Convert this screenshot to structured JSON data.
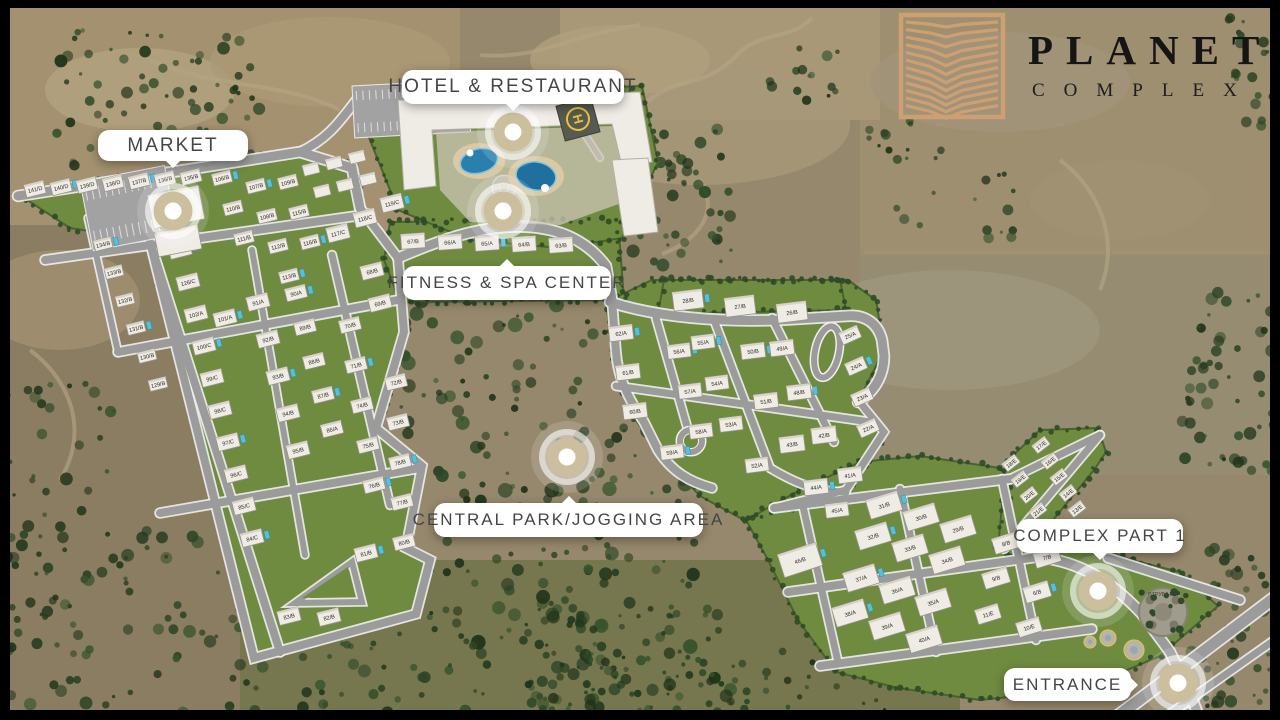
{
  "brand": {
    "title": "PLANET",
    "subtitle": "COMPLEX",
    "logo_color": "#cf9f74",
    "title_color": "#151515"
  },
  "callouts": [
    {
      "id": "market",
      "label": "MARKET",
      "x": 98,
      "y": 130,
      "w": 150,
      "h": 31,
      "font": 19,
      "pointer": "bottom",
      "marker_x": 173,
      "marker_y": 211
    },
    {
      "id": "hotel-restaurant",
      "label": "HOTEL & RESTAURANT",
      "x": 402,
      "y": 70,
      "w": 222,
      "h": 34,
      "font": 19,
      "pointer": "bottom",
      "marker_x": 513,
      "marker_y": 132
    },
    {
      "id": "fitness-spa",
      "label": "FITNESS & SPA CENTER",
      "x": 403,
      "y": 266,
      "w": 208,
      "h": 34,
      "font": 17,
      "pointer": "top",
      "marker_x": 503,
      "marker_y": 211
    },
    {
      "id": "central-park",
      "label": "CENTRAL PARK/JOGGING AREA",
      "x": 434,
      "y": 503,
      "w": 269,
      "h": 34,
      "font": 17,
      "pointer": "top",
      "marker_x": 567,
      "marker_y": 457
    },
    {
      "id": "complex-part-1",
      "label": "COMPLEX PART 1",
      "x": 1017,
      "y": 519,
      "w": 166,
      "h": 34,
      "font": 17,
      "pointer": "bottom",
      "marker_x": 1098,
      "marker_y": 591
    },
    {
      "id": "entrance",
      "label": "ENTRANCE",
      "x": 1004,
      "y": 668,
      "w": 127,
      "h": 33,
      "font": 17,
      "pointer": "right",
      "marker_x": 1178,
      "marker_y": 683
    }
  ],
  "map": {
    "colors": {
      "marker": "#cbbf9d",
      "lawn": "#6e8b40",
      "lawn_edge": "#49632f",
      "road": "#9b9b9b",
      "road_edge": "#efefef",
      "forest": "#2c4426",
      "terrain": "#96886c",
      "house": "#efece5",
      "pool": "#2a7fae"
    },
    "helipad": {
      "label": "H"
    },
    "stone_circle_label": "ВТРУБІНКА"
  },
  "houses": {
    "left_rows": [
      {
        "x": 35,
        "y": 189,
        "dx": 26,
        "dy": -2,
        "n": 7,
        "rot": -14,
        "w": 20,
        "h": 13,
        "labels": [
          "141/D",
          "140/D",
          "139/D",
          "138/D",
          "137/B",
          "136/B",
          "135/B"
        ]
      },
      {
        "x": 103,
        "y": 244,
        "dx": 11,
        "dy": 28,
        "n": 6,
        "rot": -14,
        "w": 18,
        "h": 11,
        "labels": [
          "134/B",
          "133/B",
          "132/B",
          "131/B",
          "130/B",
          "129/B"
        ]
      },
      {
        "x": 180,
        "y": 250,
        "dx": 8,
        "dy": 32,
        "n": 10,
        "rot": -14,
        "w": 22,
        "h": 14,
        "labels": [
          "127/C",
          "126/C",
          "102/A",
          "100/C",
          "99/C",
          "98/C",
          "97/C",
          "96/C",
          "85/C",
          "84/C"
        ]
      },
      {
        "x": 258,
        "y": 302,
        "dx": 10,
        "dy": 37,
        "n": 5,
        "rot": -14,
        "w": 22,
        "h": 14,
        "labels": [
          "91/A",
          "92/B",
          "93/B",
          "94/B",
          "95/B"
        ]
      },
      {
        "x": 296,
        "y": 293,
        "dx": 9,
        "dy": 34,
        "n": 5,
        "rot": -14,
        "w": 21,
        "h": 13,
        "labels": [
          "90/A",
          "89/B",
          "88/B",
          "87/B",
          "86/A"
        ]
      },
      {
        "x": 350,
        "y": 325,
        "dx": 6,
        "dy": 40,
        "n": 5,
        "rot": -14,
        "w": 21,
        "h": 13,
        "labels": [
          "70/B",
          "71/B",
          "74/B",
          "75/B",
          "76/B"
        ]
      },
      {
        "x": 396,
        "y": 382,
        "dx": 2,
        "dy": 40,
        "n": 5,
        "rot": -14,
        "w": 21,
        "h": 13,
        "labels": [
          "72/B",
          "73/B",
          "78/B",
          "77/B",
          "80/B"
        ]
      },
      {
        "x": 222,
        "y": 178,
        "dx": 11,
        "dy": 30,
        "n": 3,
        "rot": -14,
        "w": 19,
        "h": 12,
        "labels": [
          "106/B",
          "110/B",
          "111/B"
        ]
      },
      {
        "x": 256,
        "y": 186,
        "dx": 11,
        "dy": 30,
        "n": 4,
        "rot": -14,
        "w": 19,
        "h": 12,
        "labels": [
          "107/B",
          "108/B",
          "112/B",
          "113/B"
        ]
      },
      {
        "x": 288,
        "y": 182,
        "dx": 11,
        "dy": 30,
        "n": 3,
        "rot": -14,
        "w": 19,
        "h": 12,
        "labels": [
          "109/B",
          "115/B",
          "116/B"
        ]
      },
      {
        "x": 338,
        "y": 233,
        "dx": 27,
        "dy": -15,
        "n": 3,
        "rot": -14,
        "w": 22,
        "h": 15,
        "labels": [
          "117/C",
          "118/C",
          "119/C"
        ]
      },
      {
        "x": 311,
        "y": 169,
        "dx": 23,
        "dy": -6,
        "n": 3,
        "rot": -14,
        "w": 16,
        "h": 11,
        "labels": [
          "",
          "",
          ""
        ]
      },
      {
        "x": 322,
        "y": 191,
        "dx": 23,
        "dy": -6,
        "n": 3,
        "rot": -14,
        "w": 16,
        "h": 11,
        "labels": [
          "",
          "",
          ""
        ]
      },
      {
        "x": 413,
        "y": 241,
        "dx": 37,
        "dy": 1,
        "n": 5,
        "rot": -4,
        "w": 24,
        "h": 15,
        "labels": [
          "67/B",
          "66/A",
          "65/A",
          "64/B",
          "63/B"
        ]
      }
    ],
    "left_singles": [
      {
        "x": 366,
        "y": 553,
        "label": "81/B"
      },
      {
        "x": 289,
        "y": 616,
        "label": "83/B"
      },
      {
        "x": 329,
        "y": 617,
        "label": "82/B"
      },
      {
        "x": 225,
        "y": 318,
        "label": "101/A"
      },
      {
        "x": 372,
        "y": 271,
        "label": "68/B"
      },
      {
        "x": 380,
        "y": 303,
        "label": "69/B"
      }
    ],
    "right_rows": [
      {
        "x": 688,
        "y": 300,
        "dx": 52,
        "dy": 6,
        "n": 3,
        "rot": -7,
        "w": 30,
        "h": 19,
        "labels": [
          "28/B",
          "27/B",
          "26/B"
        ]
      },
      {
        "x": 621,
        "y": 333,
        "dx": 7,
        "dy": 39,
        "n": 3,
        "rot": -7,
        "w": 24,
        "h": 15,
        "labels": [
          "62/A",
          "61/B",
          "60/B"
        ]
      },
      {
        "x": 679,
        "y": 351,
        "dx": 11,
        "dy": 40,
        "n": 3,
        "rot": -7,
        "w": 23,
        "h": 14,
        "labels": [
          "56/A",
          "57/A",
          "58/A"
        ]
      },
      {
        "x": 703,
        "y": 342,
        "dx": 14,
        "dy": 41,
        "n": 3,
        "rot": -7,
        "w": 23,
        "h": 14,
        "labels": [
          "55/A",
          "54/A",
          "53/A"
        ]
      },
      {
        "x": 753,
        "y": 351,
        "dx": 13,
        "dy": 50,
        "n": 2,
        "rot": -7,
        "w": 24,
        "h": 15,
        "labels": [
          "50/B",
          "51/B"
        ]
      },
      {
        "x": 782,
        "y": 348,
        "dx": 17,
        "dy": 44,
        "n": 2,
        "rot": -7,
        "w": 24,
        "h": 15,
        "labels": [
          "49/A",
          "48/B"
        ]
      },
      {
        "x": 792,
        "y": 444,
        "dx": 32,
        "dy": -9,
        "n": 2,
        "rot": -7,
        "w": 25,
        "h": 16,
        "labels": [
          "43/B",
          "42/B"
        ]
      },
      {
        "x": 816,
        "y": 487,
        "dx": 34,
        "dy": -12,
        "n": 2,
        "rot": -7,
        "w": 24,
        "h": 15,
        "labels": [
          "44/A",
          "41/A"
        ]
      },
      {
        "x": 850,
        "y": 335,
        "dx": 6,
        "dy": 31,
        "n": 4,
        "rot": -24,
        "w": 20,
        "h": 13,
        "labels": [
          "25/A",
          "24/A",
          "23/A",
          "22/A"
        ]
      }
    ],
    "right_singles": [
      {
        "x": 672,
        "y": 452,
        "label": "59/A"
      },
      {
        "x": 757,
        "y": 465,
        "label": "52/A"
      },
      {
        "x": 837,
        "y": 510,
        "label": "45/A"
      }
    ],
    "part1_rows": [
      {
        "x": 884,
        "y": 505,
        "dx": 37,
        "dy": 12,
        "n": 3,
        "rot": -17,
        "w": 33,
        "h": 20,
        "labels": [
          "31/B",
          "30/B",
          "29/B"
        ]
      },
      {
        "x": 873,
        "y": 536,
        "dx": 37,
        "dy": 12,
        "n": 3,
        "rot": -17,
        "w": 33,
        "h": 20,
        "labels": [
          "32/B",
          "33/B",
          "34/B"
        ]
      },
      {
        "x": 861,
        "y": 578,
        "dx": 36,
        "dy": 12,
        "n": 3,
        "rot": -17,
        "w": 33,
        "h": 20,
        "labels": [
          "37/A",
          "36/A",
          "35/A"
        ]
      },
      {
        "x": 850,
        "y": 613,
        "dx": 37,
        "dy": 13,
        "n": 3,
        "rot": -17,
        "w": 33,
        "h": 20,
        "labels": [
          "38/A",
          "39/A",
          "40/A"
        ]
      },
      {
        "x": 1006,
        "y": 543,
        "dx": 41,
        "dy": 14,
        "n": 2,
        "rot": -17,
        "w": 26,
        "h": 16,
        "labels": [
          "8/B",
          "7/B"
        ]
      },
      {
        "x": 996,
        "y": 578,
        "dx": 41,
        "dy": 14,
        "n": 2,
        "rot": -17,
        "w": 26,
        "h": 16,
        "labels": [
          "9/B",
          "6/B"
        ]
      },
      {
        "x": 988,
        "y": 614,
        "dx": 41,
        "dy": 13,
        "n": 2,
        "rot": -17,
        "w": 24,
        "h": 15,
        "labels": [
          "11/E",
          "10/E"
        ]
      }
    ],
    "estrip_rows": [
      {
        "x": 1011,
        "y": 463,
        "dx": 9,
        "dy": 16,
        "n": 4,
        "rot": -38,
        "w": 16,
        "h": 10,
        "labels": [
          "18/E",
          "19/E",
          "20/E",
          "21/E"
        ]
      },
      {
        "x": 1041,
        "y": 445,
        "dx": 9,
        "dy": 16,
        "n": 5,
        "rot": -38,
        "w": 16,
        "h": 10,
        "labels": [
          "17/E",
          "16/E",
          "15/E",
          "14/E",
          "13/E"
        ]
      }
    ],
    "big_buildings": [
      {
        "x": 800,
        "y": 560,
        "w": 40,
        "h": 24,
        "rot": -18,
        "label": "46/B"
      },
      {
        "x": 176,
        "y": 207,
        "w": 52,
        "h": 34,
        "rot": -11,
        "label": ""
      },
      {
        "x": 178,
        "y": 241,
        "w": 44,
        "h": 24,
        "rot": -11,
        "label": ""
      }
    ]
  }
}
